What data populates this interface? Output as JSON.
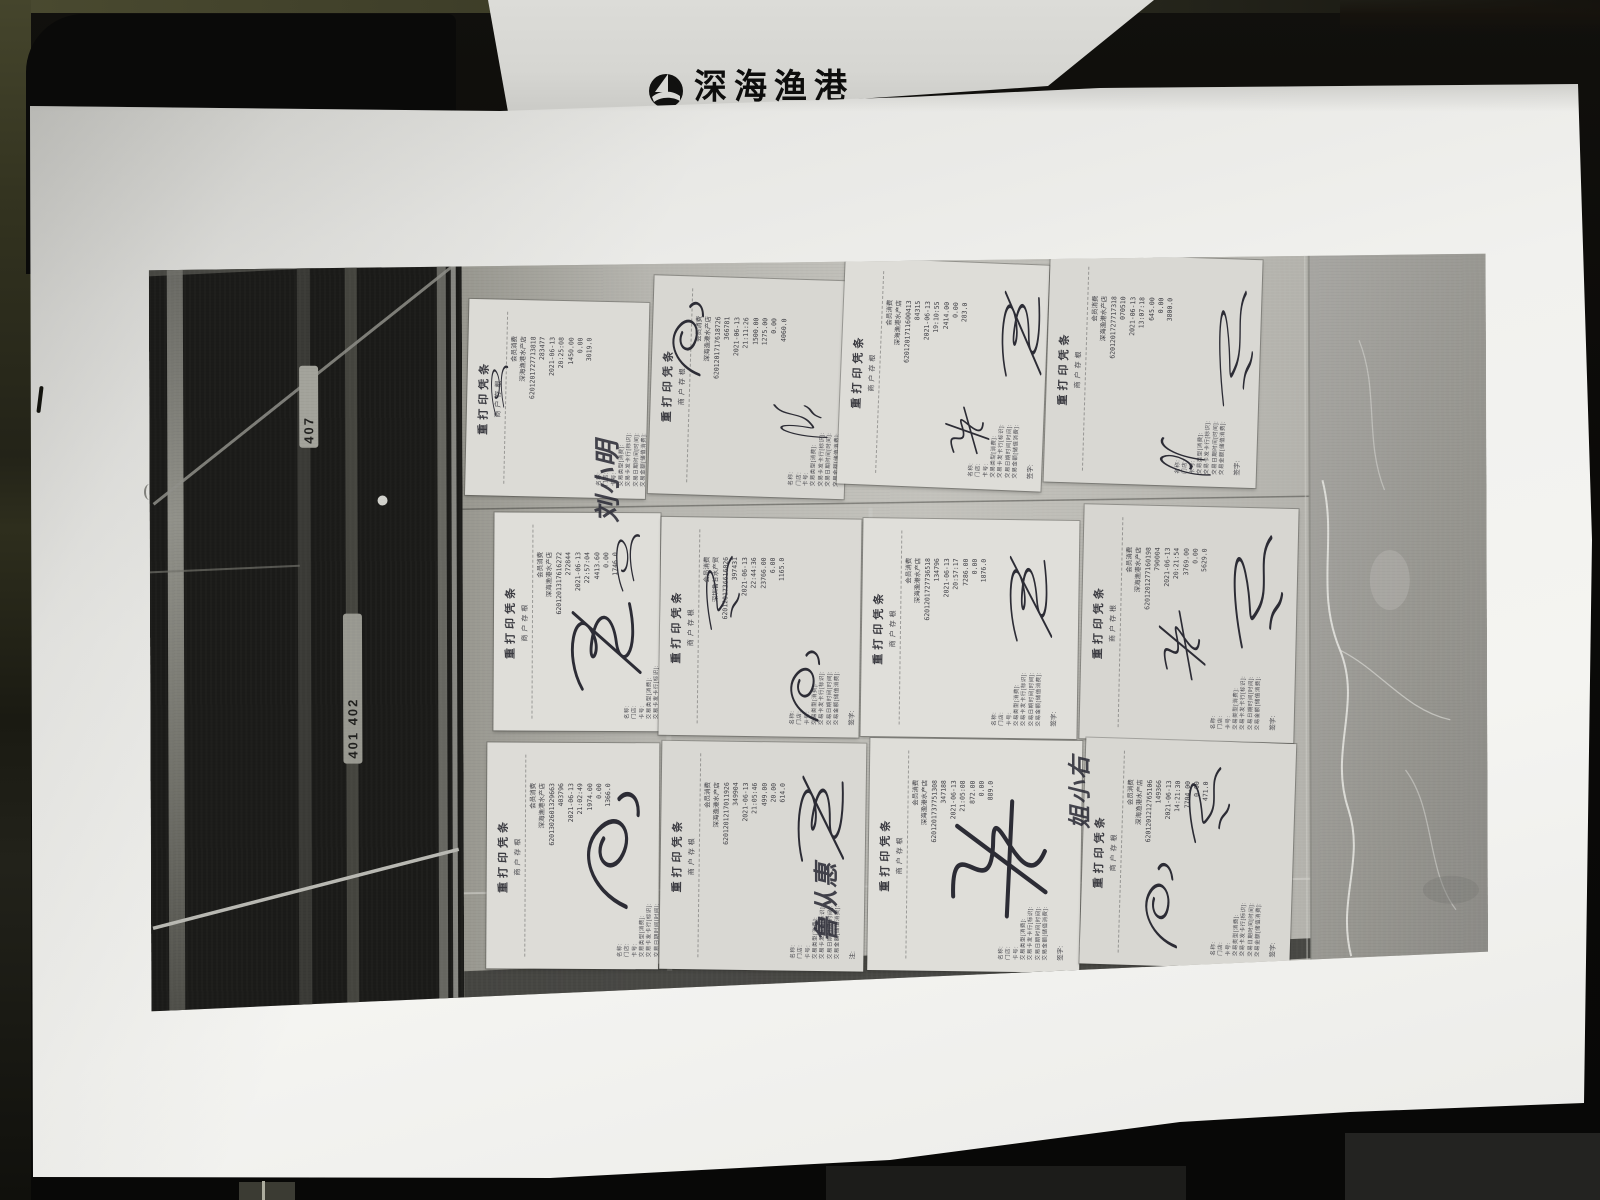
{
  "palette": {
    "background": "#0b0a08",
    "olive": "#3a3a26",
    "paper": "#f1f1ee",
    "photo_floor": "#c2c1bc",
    "door_dark": "#1b1b19",
    "marble": "#9e9d99",
    "ink": "#2c2c35",
    "receipt_paper": "#dcdbd6"
  },
  "background_sheet": {
    "logo_text": "深海渔港",
    "logo_mark": "sail-circle-logo"
  },
  "photo": {
    "door": {
      "labels": [
        "407",
        "401 402"
      ]
    },
    "receipt_common": {
      "header": "重打印凭条",
      "stub": "商户存根",
      "field_labels": [
        "名称:",
        "门店:",
        "卡号:",
        "交易类型[消费]:",
        "交易卡发卡行[标识]:",
        "交易日期时间[时间]:",
        "交易金额[储值消费]:"
      ]
    },
    "receipts": [
      {
        "box": {
          "x": 318,
          "y": 48,
          "w": 180,
          "h": 196,
          "r": 1.5
        },
        "shade": "#dcdbd6",
        "type_line": "会员消费",
        "merchant": "深海渔港水产店",
        "card": "6201201727713818",
        "terminal": "283477",
        "date": "2021-06-13",
        "time": "20:25:08",
        "amount": "1450.00",
        "fee": "0.00",
        "balance": "3019.0",
        "sign_label": "注:"
      },
      {
        "box": {
          "x": 502,
          "y": 26,
          "w": 196,
          "h": 218,
          "r": 2
        },
        "shade": "#d8d7d2",
        "type_line": "会员消费",
        "merchant": "深海渔港水产店",
        "card": "6201201717618726",
        "terminal": "366781",
        "date": "2021-06-13",
        "time": "21:11:26",
        "amount": "1500.00",
        "amount2": "1275.00",
        "fee": "0.00",
        "balance": "4060.0",
        "sign_label": "注:"
      },
      {
        "box": {
          "x": 692,
          "y": 10,
          "w": 204,
          "h": 226,
          "r": 2.5
        },
        "shade": "#deddd8",
        "type_line": "会员消费",
        "merchant": "深海渔港水产店",
        "card": "6201201711600413",
        "terminal": "84315",
        "date": "2021-06-13",
        "time": "19:10:55",
        "amount": "2414.00",
        "fee": "0.00",
        "balance": "283.0",
        "sign_label": "签字:"
      },
      {
        "box": {
          "x": 898,
          "y": 6,
          "w": 212,
          "h": 228,
          "r": 2
        },
        "shade": "#d9d8d3",
        "type_line": "会员消费",
        "merchant": "深海渔港水产店",
        "card": "6201201727717318",
        "terminal": "070510",
        "date": "2021-06-13",
        "time": "13:07:18",
        "amount": "645.00",
        "fee": "0.00",
        "balance": "3800.0",
        "sign_label": "签字:"
      },
      {
        "box": {
          "x": 344,
          "y": 260,
          "w": 166,
          "h": 218,
          "r": 0.5
        },
        "shade": "#dfded9",
        "type_line": "会员消费",
        "merchant": "深海渔港水产店",
        "card": "6201201317616272",
        "terminal": "272844",
        "date": "2021-06-13",
        "time": "22:57:04",
        "amount": "4413.60",
        "fee": "0.00",
        "balance": "1746.0",
        "sign_label": "注:"
      },
      {
        "box": {
          "x": 510,
          "y": 266,
          "w": 200,
          "h": 218,
          "r": 1
        },
        "shade": "#dad9d4",
        "type_line": "会员消费",
        "merchant": "深圳鲁甘水产贸",
        "card": "6201201736616026",
        "terminal": "397431",
        "date": "2021-06-13",
        "time": "22:44:36",
        "amount": "23766.00",
        "fee": "6.00",
        "balance": "1165.0",
        "sign_label": "签字:"
      },
      {
        "box": {
          "x": 712,
          "y": 268,
          "w": 216,
          "h": 218,
          "r": 1
        },
        "shade": "#e0dfda",
        "type_line": "会员消费",
        "merchant": "深海渔港水产店",
        "card": "6201201727736518",
        "terminal": "134796",
        "date": "2021-06-13",
        "time": "20:57:17",
        "amount": "7286.00",
        "fee": "0.00",
        "balance": "1876.0",
        "sign_label": "签字:"
      },
      {
        "box": {
          "x": 932,
          "y": 256,
          "w": 214,
          "h": 234,
          "r": 1.5
        },
        "shade": "#d7d6d1",
        "type_line": "会员消费",
        "merchant": "深海渔港水产店",
        "card": "6201201277160198",
        "terminal": "790004",
        "date": "2021-06-13",
        "time": "20:21:54",
        "amount": "3769.00",
        "fee": "0.00",
        "balance": "5629.0",
        "sign_label": "签字:"
      },
      {
        "box": {
          "x": 336,
          "y": 490,
          "w": 172,
          "h": 226,
          "r": 0.5
        },
        "shade": "#dddcd7",
        "type_line": "会员消费",
        "merchant": "深海渔港水产店",
        "card": "6201302601329663",
        "terminal": "403796",
        "date": "2021-06-13",
        "time": "21:02:49",
        "amount": "1974.00",
        "fee": "0.00",
        "balance": "1366.0",
        "sign_label": "签字:"
      },
      {
        "box": {
          "x": 510,
          "y": 490,
          "w": 204,
          "h": 228,
          "r": 1
        },
        "shade": "#d9d8d3",
        "type_line": "会员消费",
        "merchant": "深海渔港水产店",
        "card": "6201201217011926",
        "terminal": "349904",
        "date": "2021-06-13",
        "time": "21:05:46",
        "amount": "499.00",
        "fee": "20.00",
        "balance": "614.0",
        "sign_label": "注:"
      },
      {
        "box": {
          "x": 718,
          "y": 488,
          "w": 212,
          "h": 232,
          "r": 1
        },
        "shade": "#dfded9",
        "type_line": "会员消费",
        "merchant": "深海渔港水产店",
        "card": "6201201737751308",
        "terminal": "347188",
        "date": "2021-06-13",
        "time": "21:05:08",
        "amount": "872.00",
        "fee": "0.00",
        "balance": "889.0",
        "sign_label": "签字:"
      },
      {
        "box": {
          "x": 932,
          "y": 490,
          "w": 210,
          "h": 226,
          "r": 2
        },
        "shade": "#d8d7d2",
        "type_line": "会员消费",
        "merchant": "深海渔港水产店",
        "card": "6201201212765106",
        "terminal": "149366",
        "date": "2021-06-13",
        "time": "14:21:30",
        "amount": "7704.00",
        "fee": "0.00",
        "balance": "471.0",
        "sign_label": "签字:"
      }
    ],
    "signatures": [
      {
        "s": "s1",
        "x": 336,
        "y": 96,
        "w": 30,
        "h": 74,
        "r": -8
      },
      {
        "text": "刘小明",
        "x": 438,
        "y": 178,
        "w": 36,
        "h": 92
      },
      {
        "s": "s5",
        "x": 505,
        "y": 34,
        "w": 66,
        "h": 98,
        "r": -12
      },
      {
        "s": "s3",
        "x": 628,
        "y": 132,
        "w": 40,
        "h": 76,
        "r": -85
      },
      {
        "s": "s2",
        "x": 845,
        "y": 20,
        "w": 54,
        "h": 124,
        "r": -6
      },
      {
        "s": "s4",
        "x": 788,
        "y": 146,
        "w": 54,
        "h": 64,
        "r": -30
      },
      {
        "s": "s3",
        "x": 1062,
        "y": 16,
        "w": 44,
        "h": 152,
        "r": -4
      },
      {
        "s": "s1",
        "x": 1008,
        "y": 164,
        "w": 46,
        "h": 84,
        "r": -80
      },
      {
        "s": "s1",
        "x": 458,
        "y": 264,
        "w": 42,
        "h": 82,
        "r": -10
      },
      {
        "s": "s2",
        "x": 406,
        "y": 334,
        "w": 94,
        "h": 114,
        "r": -18
      },
      {
        "s": "s3",
        "x": 548,
        "y": 290,
        "w": 44,
        "h": 94,
        "r": -8
      },
      {
        "s": "s5",
        "x": 622,
        "y": 384,
        "w": 64,
        "h": 94,
        "r": -14
      },
      {
        "s": "s2",
        "x": 852,
        "y": 284,
        "w": 54,
        "h": 124,
        "r": -10
      },
      {
        "s": "s3",
        "x": 1072,
        "y": 264,
        "w": 64,
        "h": 144,
        "r": -8
      },
      {
        "s": "s4",
        "x": 1002,
        "y": 344,
        "w": 54,
        "h": 94,
        "r": -20
      },
      {
        "s": "s5",
        "x": 408,
        "y": 514,
        "w": 104,
        "h": 154,
        "r": -8
      },
      {
        "s": "s2",
        "x": 638,
        "y": 504,
        "w": 64,
        "h": 124,
        "r": -6
      },
      {
        "text": "鲁从惠",
        "x": 656,
        "y": 606,
        "w": 34,
        "h": 84
      },
      {
        "s": "s4",
        "x": 778,
        "y": 524,
        "w": 134,
        "h": 154,
        "r": -12
      },
      {
        "text": "姐小右",
        "x": 910,
        "y": 500,
        "w": 30,
        "h": 78
      },
      {
        "s": "s3",
        "x": 1028,
        "y": 504,
        "w": 54,
        "h": 94,
        "r": -10
      },
      {
        "s": "s5",
        "x": 976,
        "y": 594,
        "w": 64,
        "h": 114,
        "r": -16
      }
    ]
  }
}
